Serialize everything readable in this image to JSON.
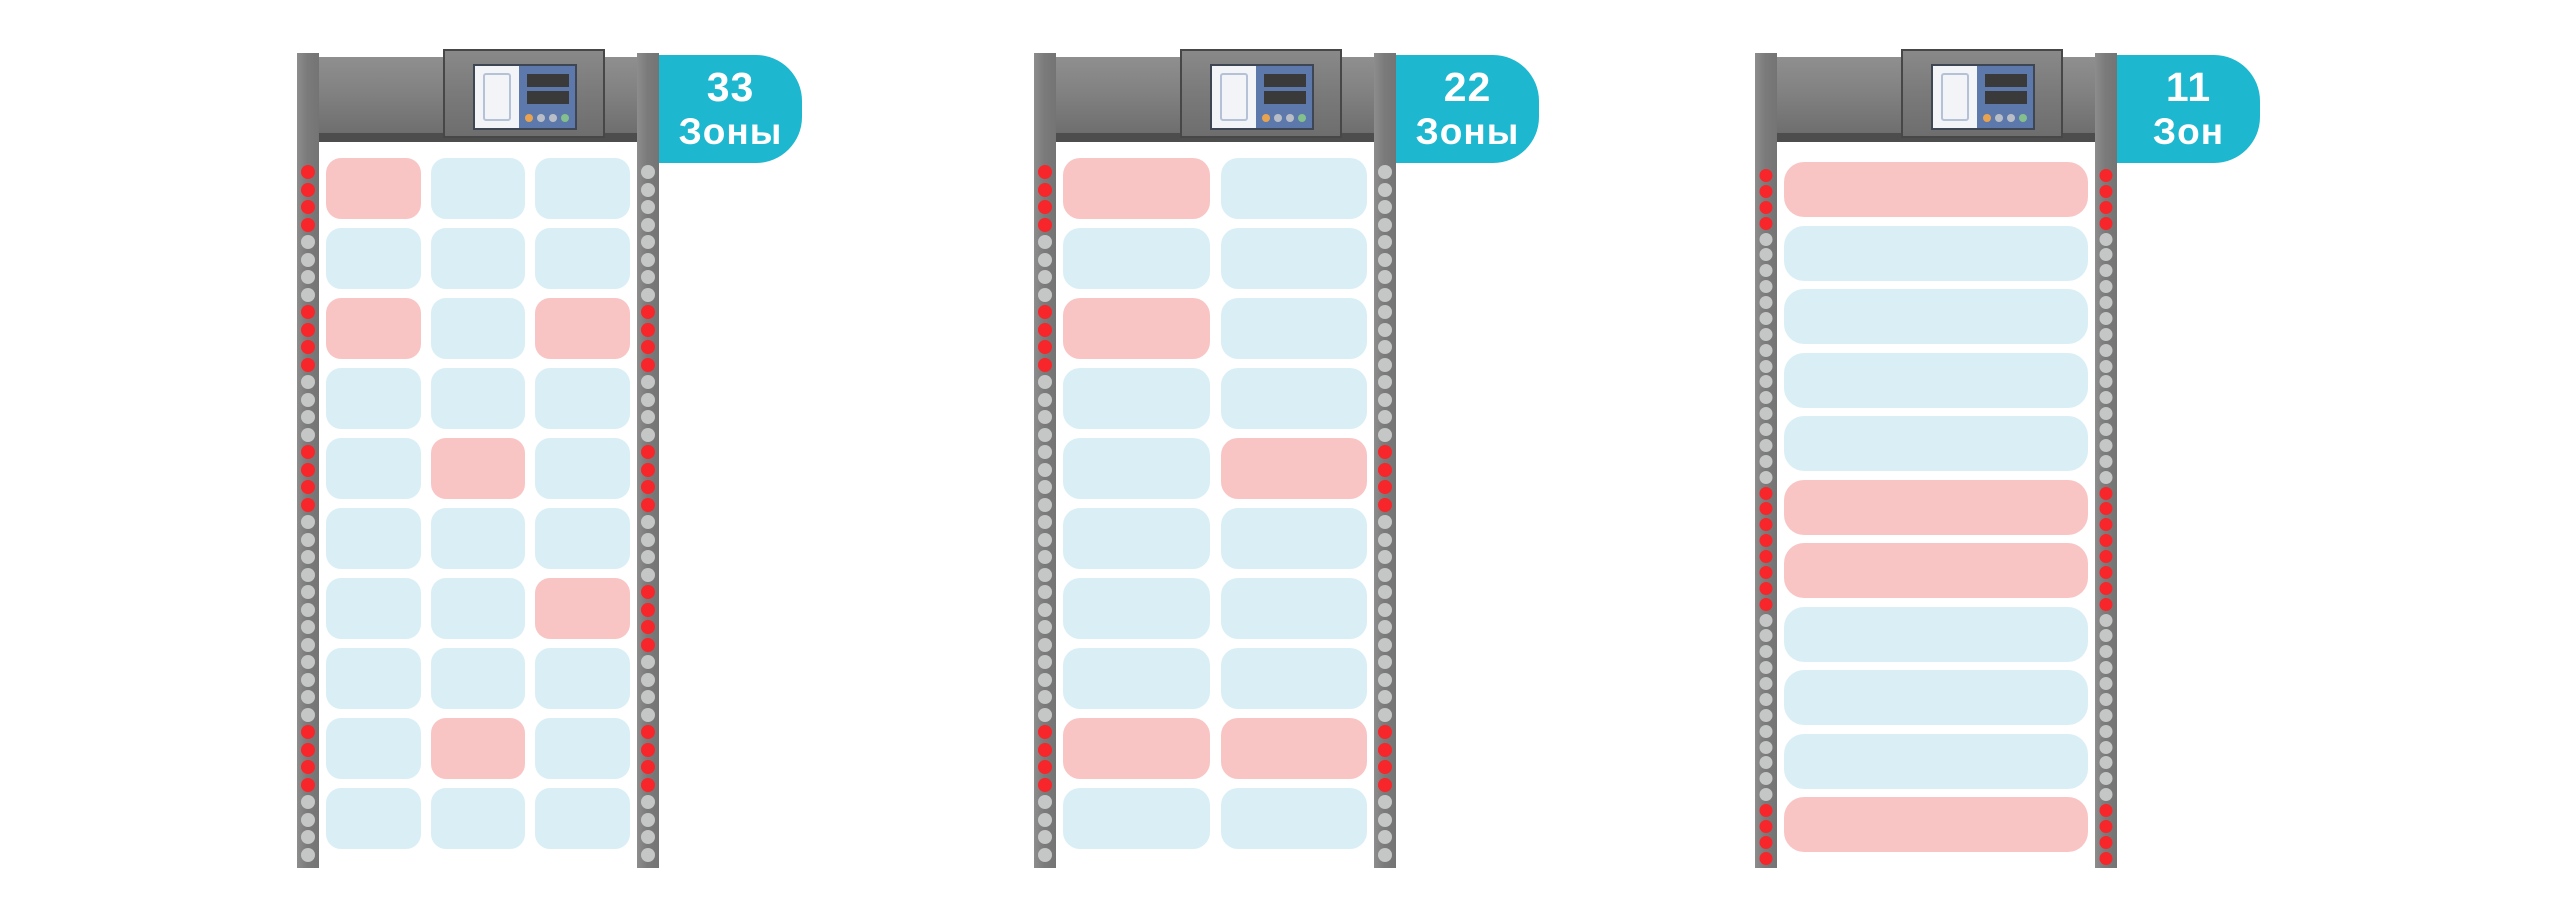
{
  "colors": {
    "zone_clear": "#d9eff5",
    "zone_alarm": "#f9c5c4",
    "led_alarm": "#f7262b",
    "led_idle": "#c5c6c6",
    "badge_bg": "#1db7cf",
    "badge_text": "#ffffff",
    "crossbar_dark": "#4d4d4d",
    "panel_blue": "#5d79ac",
    "panel_screen": "#3a3a3a",
    "panel_white": "#f2f4f7",
    "door_outline": "#b5c1d6",
    "button_orange": "#e9a24e",
    "button_gray": "#b9bec6",
    "button_green": "#84c08c"
  },
  "detectors": [
    {
      "badge": {
        "count": "33",
        "unit": "Зоны"
      },
      "columns": 3,
      "rows": 10,
      "alarm_cells": [
        [
          1,
          1
        ],
        [
          3,
          1
        ],
        [
          3,
          3
        ],
        [
          5,
          2
        ],
        [
          7,
          3
        ],
        [
          9,
          2
        ]
      ],
      "led_left_rows": [
        1,
        3,
        5,
        9
      ],
      "led_right_rows": [
        3,
        5,
        7,
        9
      ]
    },
    {
      "badge": {
        "count": "22",
        "unit": "Зоны"
      },
      "columns": 2,
      "rows": 10,
      "alarm_cells": [
        [
          1,
          1
        ],
        [
          3,
          1
        ],
        [
          5,
          2
        ],
        [
          9,
          1
        ],
        [
          9,
          2
        ]
      ],
      "led_left_rows": [
        1,
        3,
        9
      ],
      "led_right_rows": [
        5,
        9
      ]
    },
    {
      "badge": {
        "count": "11",
        "unit": "Зон"
      },
      "columns": 1,
      "rows": 11,
      "alarm_cells": [
        [
          1,
          1
        ],
        [
          6,
          1
        ],
        [
          7,
          1
        ],
        [
          11,
          1
        ]
      ],
      "led_left_rows": [
        1,
        6,
        7,
        11
      ],
      "led_right_rows": [
        1,
        6,
        7,
        11
      ]
    }
  ]
}
